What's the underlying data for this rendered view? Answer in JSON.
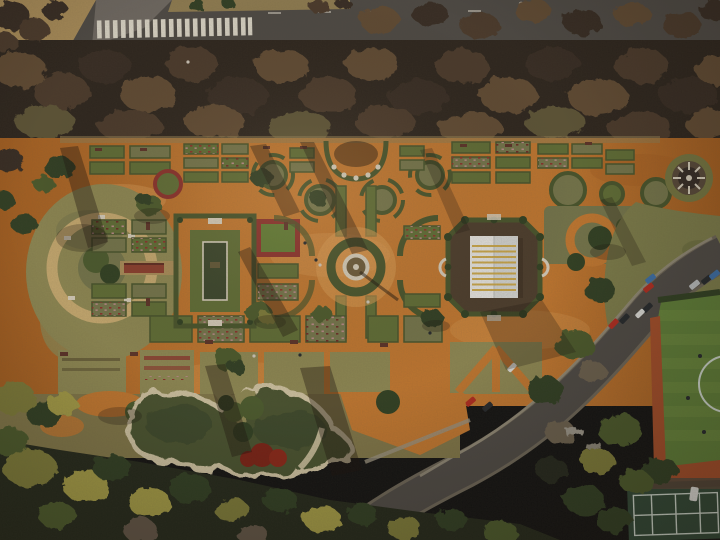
{
  "meta": {
    "title": "Aerial drone photograph of a formal rose garden park (parterre garden) in winter light",
    "description": "Top-down view: tree-lined avenue with zebra crosswalk at top, large geometric rose garden with orange gravel paths, rectangular reflecting pool, central round fountain, white-roofed pergola pavilion, circular plaza, curved pond with stone edge at lower left, diagonal street with parked cars, green sports field and tennis court at lower right, dense tree canopy along the bottom.",
    "visible_text": ""
  },
  "scene": {
    "regions": [
      {
        "name": "avenue",
        "label": "asphalt road with zebra crosswalk"
      },
      {
        "name": "tree-band",
        "label": "row of bare winter trees along avenue"
      },
      {
        "name": "rose-garden",
        "label": "formal parterre beds on orange gravel"
      },
      {
        "name": "circle-plaza",
        "label": "circular plaza with central mound and pergola walkway"
      },
      {
        "name": "reflecting-pool",
        "label": "rectangular pool framed by double hedges"
      },
      {
        "name": "fountain",
        "label": "central round fountain with white rim"
      },
      {
        "name": "pavilion",
        "label": "white striped roof pavilion inside octagonal hedge"
      },
      {
        "name": "gazebo",
        "label": "round gazebo with radial benches"
      },
      {
        "name": "pond",
        "label": "curved ornamental pond with stone edging and red shrubs"
      },
      {
        "name": "street",
        "label": "diagonal street with parked cars"
      },
      {
        "name": "sports-field",
        "label": "green hockey field with red running track edge"
      },
      {
        "name": "tennis-court",
        "label": "dark green tennis court with white lines"
      },
      {
        "name": "south-woods",
        "label": "dense mixed tree canopy"
      }
    ]
  },
  "palette": {
    "gravel": "#c1762e",
    "gravelLight": "#d99a52",
    "gravelDark": "#a35d1f",
    "asphalt": "#4c4844",
    "asphaltLight": "#6e6862",
    "kerb": "#6b6456",
    "sidewalk": "#97907d",
    "crosswalk": "#dcd7c9",
    "tanGrass": "#a98c58",
    "tanStrip": "#8f7c50",
    "bandBase": "#2b231c",
    "canopyBrown": "#5e4933",
    "canopyMid": "#49392a",
    "canopyDark": "#352a20",
    "canopyOlive": "#5c5336",
    "hedge": "#46532a",
    "bedGreen": "#5e6c34",
    "bedOlive": "#73744a",
    "grassTan": "#8d8752",
    "lawnGreen": "#5f7a33",
    "flowerRed": "#8a2f2a",
    "flowerPink": "#b98989",
    "treeDark": "#2e3e21",
    "treeGreen": "#49592c",
    "treeOlive": "#7c7a38",
    "treeYellow": "#a29a44",
    "ringTan": "#c6a96f",
    "stone": "#d5cdbb",
    "walkRed": "#8a3c2c",
    "dirt": "#4a3b2b",
    "water": "#46512d",
    "waterDark": "#38442a",
    "pondEdge": "#cfc3a2",
    "redBush": "#7a2014",
    "roofWhite": "#e7e6e3",
    "roofShade": "#d3d4d2",
    "roofStripe": "#c8a23c",
    "fieldGreen": "#5d7d36",
    "fieldStripe": "#6d8c3e",
    "track": "#a34c28",
    "court": "#2e4635",
    "courtLine": "#ccd6cc",
    "carRed": "#b02a1e",
    "carBlue": "#3a6ea8",
    "carSilver": "#b9bdbf",
    "carDark": "#23272b",
    "carWhite": "#dcdcd8",
    "shadow": "rgba(25,17,10,0.38)",
    "shadowSoft": "rgba(25,17,10,0.26)"
  }
}
